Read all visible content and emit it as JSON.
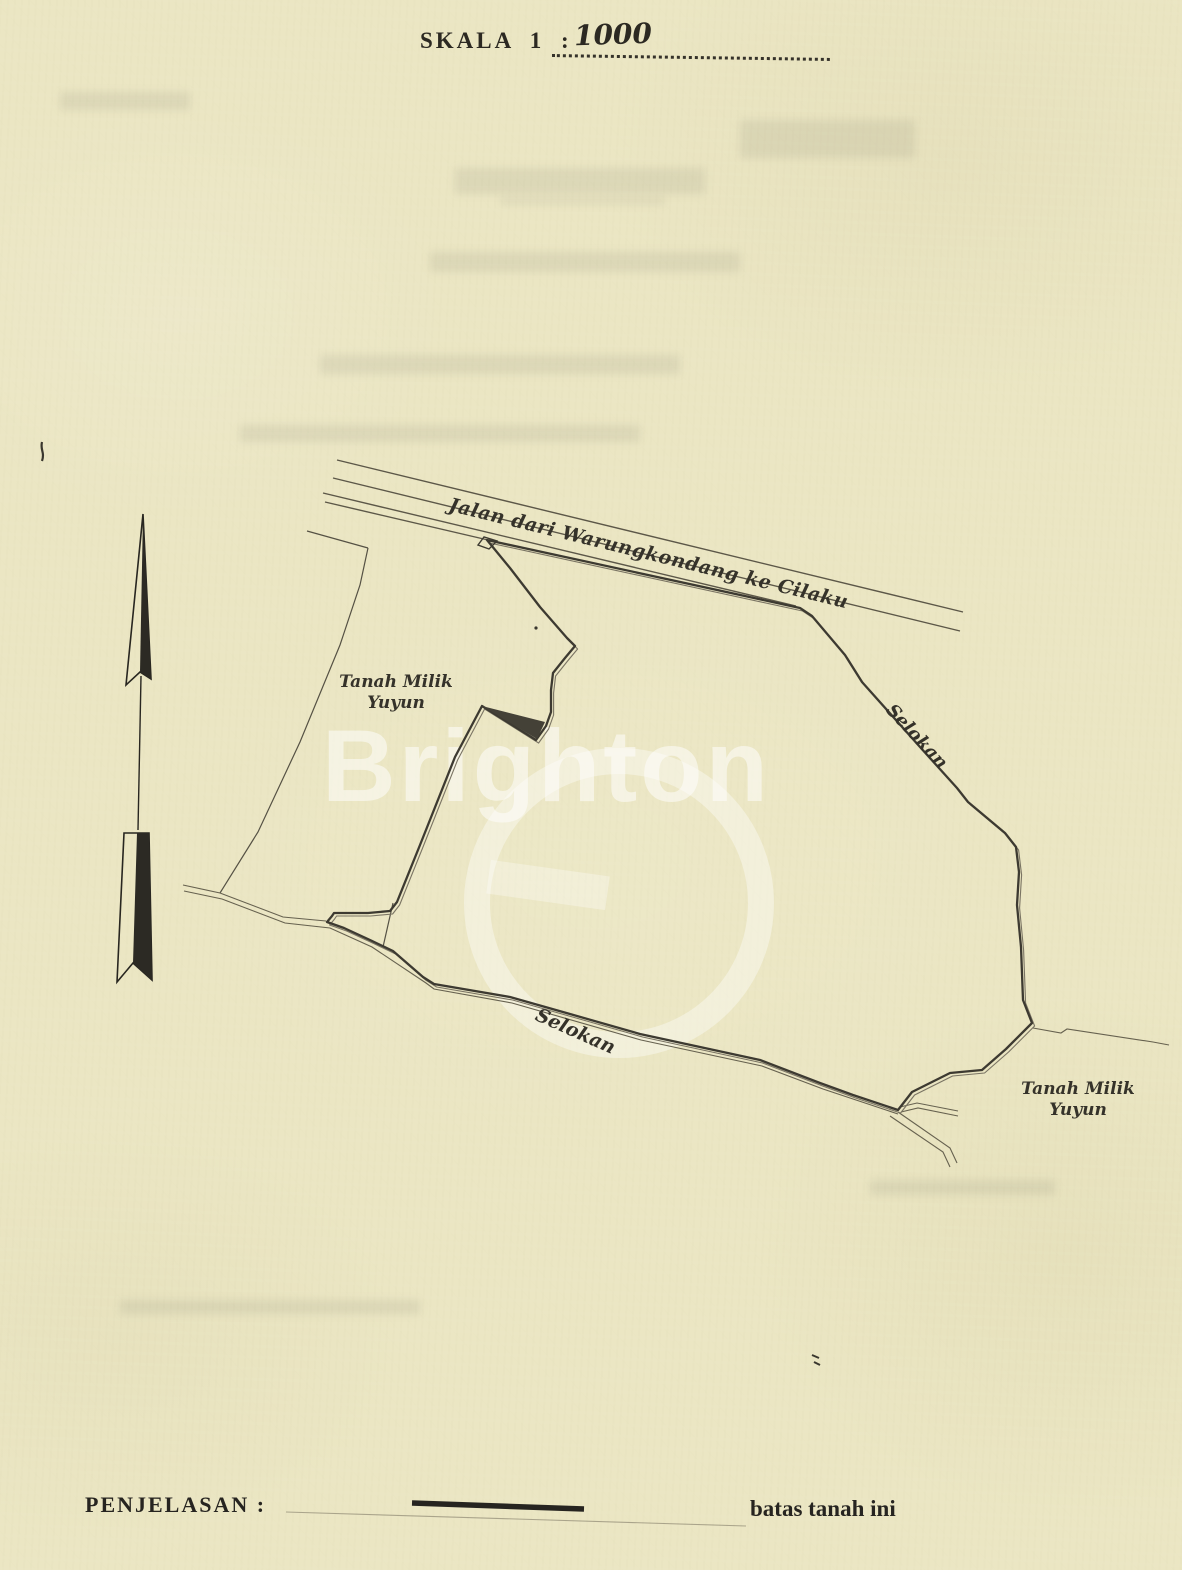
{
  "document": {
    "scale_label": "SKALA 1 :",
    "scale_value": "1000",
    "legend_label": "PENJELASAN :",
    "legend_line_meaning": "batas tanah ini",
    "watermark_text": "Brighton"
  },
  "map": {
    "road_label": "Jalan dari Warungkondang ke Cilaku",
    "ditch_label_right": "Selokan",
    "ditch_label_bottom": "Selokan",
    "owner_parcel_left": {
      "line1": "Tanah Milik",
      "line2": "Yuyun"
    },
    "owner_parcel_bottom_right": {
      "line1": "Tanah Milik",
      "line2": "Yuyun"
    }
  },
  "colors": {
    "paper": "#ebe6c3",
    "ink": "#3d3a31",
    "ink_light": "#7a7463",
    "watermark": "#ffffff"
  }
}
